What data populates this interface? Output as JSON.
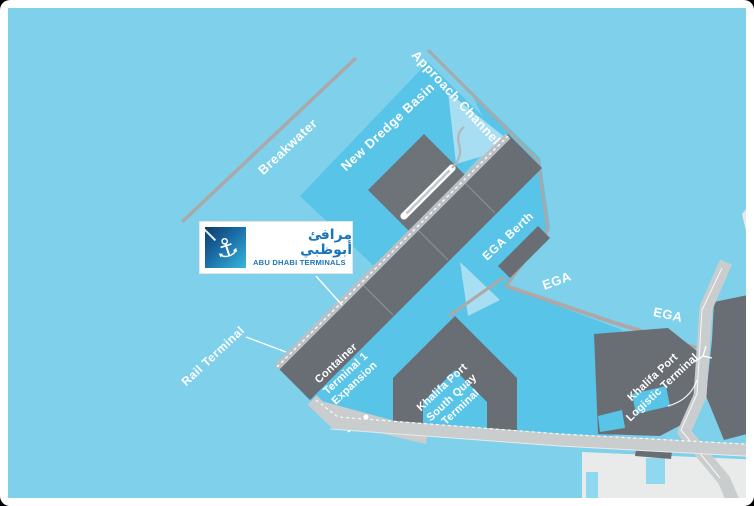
{
  "logo": {
    "arabic": "مرافئ أبوظبي",
    "english": "ABU DHABI TERMINALS"
  },
  "icons": {
    "anchor": "⚓"
  },
  "labels": {
    "breakwater": "Breakwater",
    "new_dredge_basin": "New Dredge Basin",
    "approach_channel": "Approach Channel",
    "ega_berth": "EGA Berth",
    "ega_1": "EGA",
    "ega_2": "EGA",
    "rail_terminal": "Rail Terminal",
    "container_terminal": {
      "line1": "Container",
      "line2": "Terminal 1",
      "line3": "Expansion"
    },
    "south_quay": {
      "line1": "Khalifa Port",
      "line2": "South Quay",
      "line3": "Terminal"
    },
    "logistic_terminal": {
      "line1": "Khalifa Port",
      "line2": "Logistic Terminal"
    }
  },
  "colors": {
    "water_light": "#7ED0EB",
    "water_mid": "#58C4E7",
    "water_pale": "#A7DEF2",
    "terminal_gray": "#696E74",
    "terminal_gray_light": "#6E737A",
    "road_light": "#C9CDCE",
    "road_tan": "#AEA9A6",
    "line_gray": "#A9A9A9",
    "land_white": "#E9EBEB",
    "logo_blue": "#1B75BC",
    "label_white": "#FFFFFF"
  }
}
